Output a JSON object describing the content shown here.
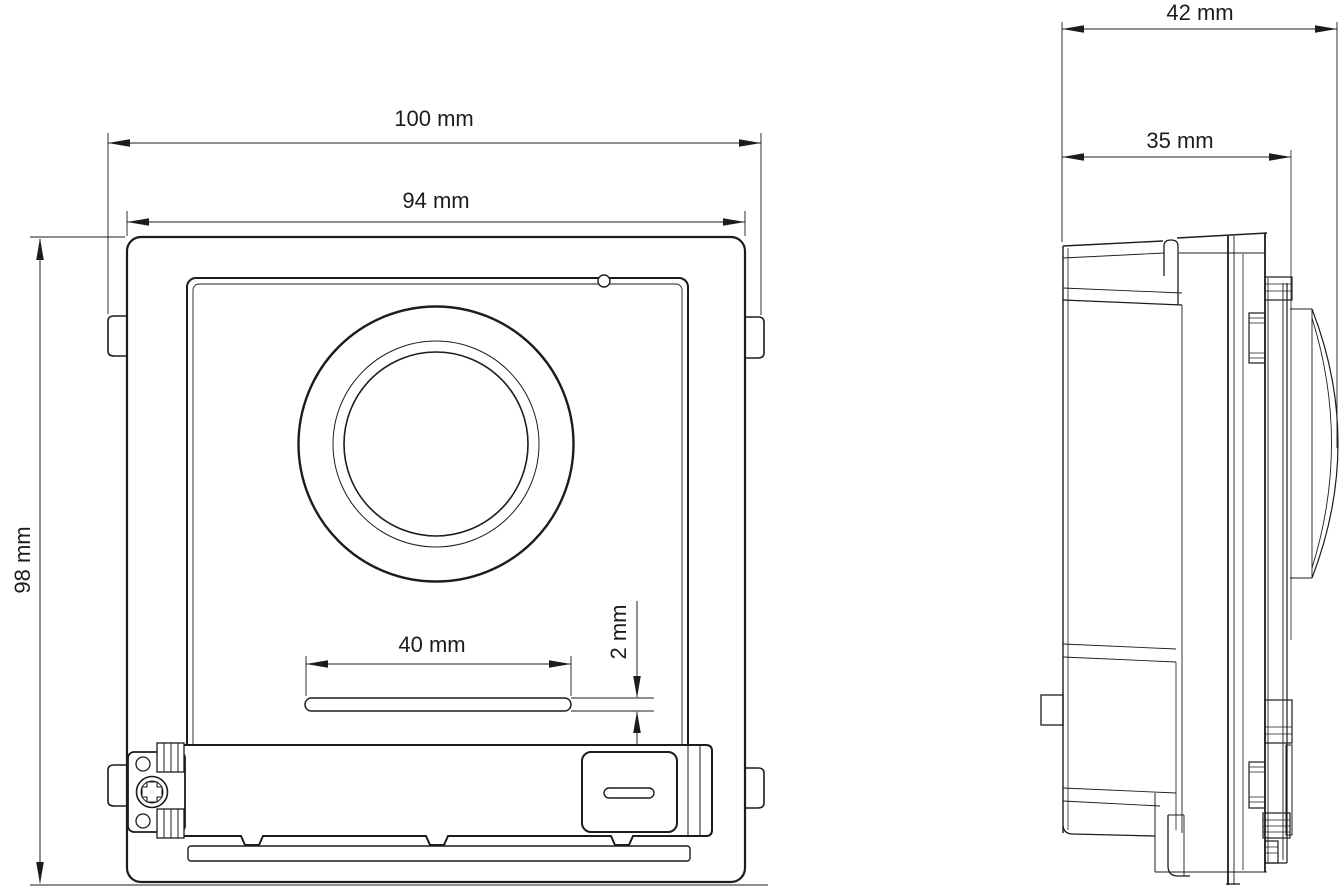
{
  "drawing": {
    "type": "technical-dimension-drawing",
    "background": "#ffffff",
    "line_color": "#1c1c1c",
    "front_view": {
      "dimensions": {
        "outer_width": "100 mm",
        "panel_width": "94 mm",
        "height": "98 mm",
        "slot_width": "40 mm",
        "slot_height": "2 mm"
      }
    },
    "side_view": {
      "dimensions": {
        "total_depth": "42 mm",
        "body_depth": "35 mm"
      }
    }
  }
}
